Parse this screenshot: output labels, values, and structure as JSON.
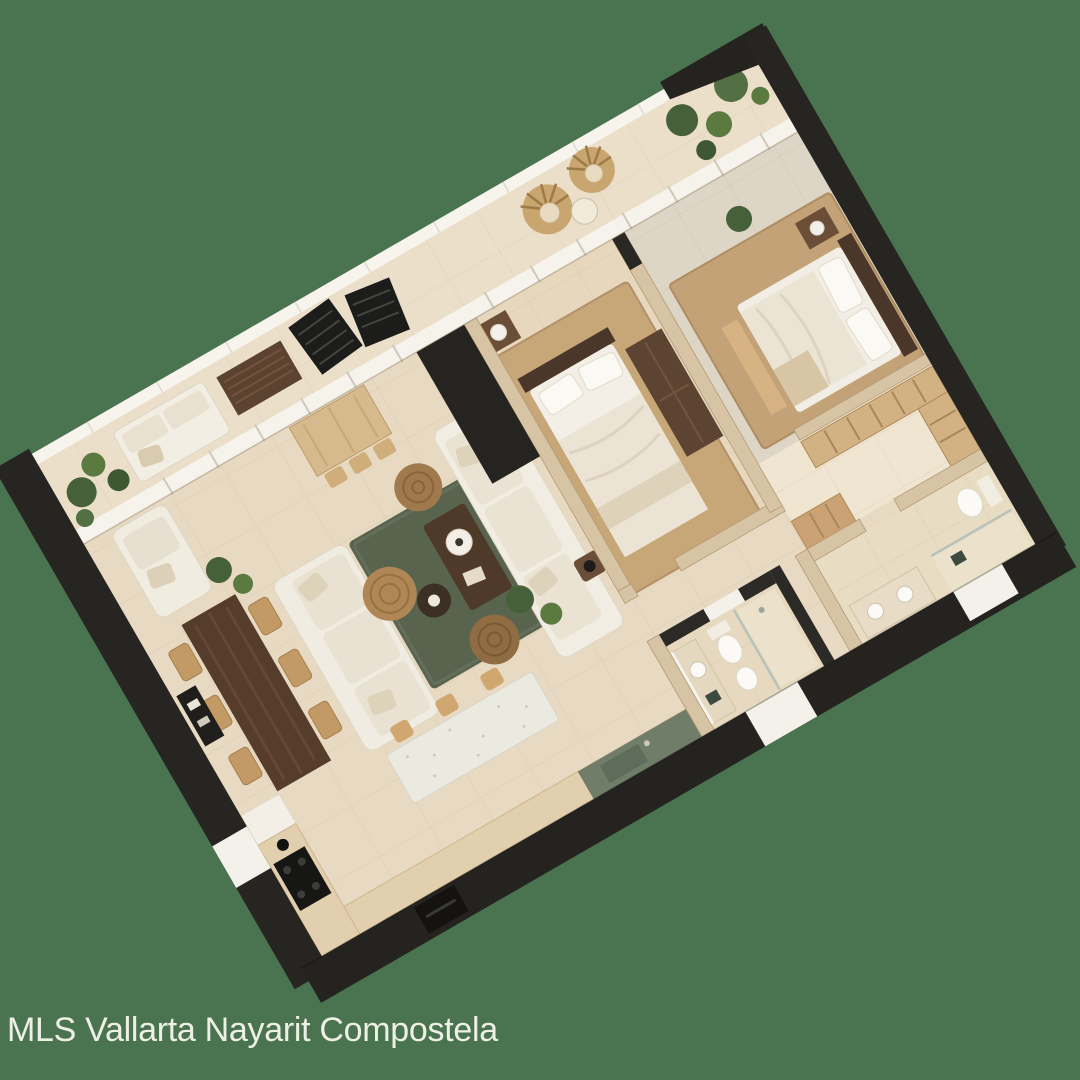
{
  "watermark": {
    "text": "MLS Vallarta Nayarit Compostela",
    "color": "#eef0e6"
  },
  "background_color": "#4a734f",
  "plan": {
    "type": "3d-rendered-floor-plan",
    "rotation_deg": -30,
    "colors": {
      "wall_dark": "#262521",
      "wall_light": "#d7c4a5",
      "floor_tile": "#e8dac2",
      "glass_frame_white": "#f6f3ec",
      "rug_green": "#59644f",
      "rug_jute": "#c7a678",
      "wood_dark": "#553c2b",
      "wood_light": "#d2b183",
      "upholstery_white": "#f2ede2",
      "counter_green": "#707d69",
      "plant_green": "#46613a",
      "accent_red": "#a23524"
    },
    "rooms": [
      "terrace",
      "living-room",
      "dining-area",
      "kitchen",
      "bedroom-1",
      "bedroom-2",
      "walk-in-closet",
      "bathroom-1",
      "bathroom-2",
      "hallway"
    ]
  }
}
